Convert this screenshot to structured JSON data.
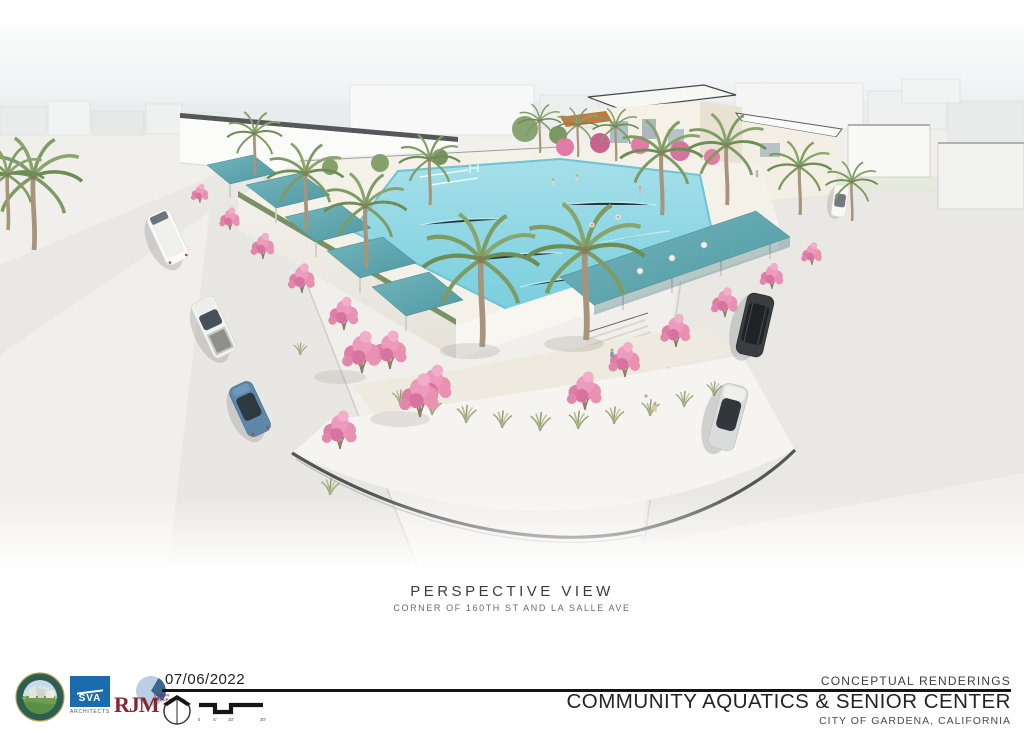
{
  "board": {
    "caption": {
      "title": "PERSPECTIVE VIEW",
      "subtitle": "CORNER OF 160TH ST AND LA SALLE AVE"
    },
    "footer": {
      "date": "07/06/2022",
      "series_label": "CONCEPTUAL RENDERINGS",
      "project_title": "COMMUNITY AQUATICS & SENIOR CENTER",
      "location": "CITY OF GARDENA, CALIFORNIA",
      "logos": {
        "city_seal_text": "CITY OF GARDENA",
        "sva_label": "SVA",
        "sva_sublabel": "ARCHITECTS",
        "rjm_label": "RJM",
        "rjm_sublabel": "DESIGN GROUP"
      },
      "scale_bar": {
        "labels": [
          "0",
          "5'",
          "10'",
          "20'"
        ]
      }
    },
    "palette": {
      "pool_water": "#8ed9e4",
      "shade_canopy_teal": "#58a3ab",
      "building_teal_accent": "#5d939a",
      "trellis_orange": "#c8803f",
      "crape_myrtle_pink": "#e891b2",
      "palm_green": "#7e9b64",
      "sva_blue": "#1b6cae",
      "rjm_red": "#8a2532",
      "ink": "#151515"
    }
  }
}
